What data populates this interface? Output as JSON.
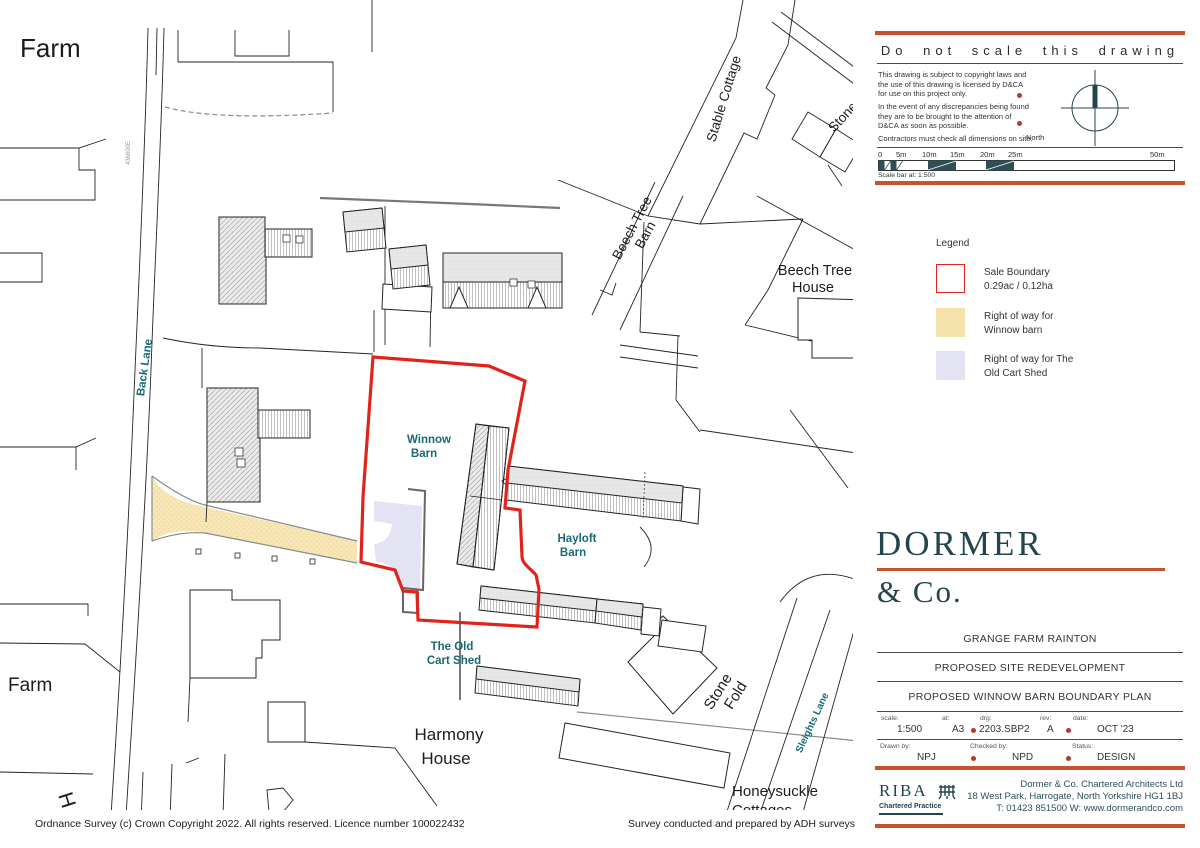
{
  "map": {
    "labels": {
      "farm_top": "Farm",
      "farm_bottom": "Farm",
      "h_partial": "H",
      "grid_ref": "436600E",
      "back_lane": "Back Lane",
      "stable_cottage": "Stable Cottage",
      "stone_top": "Stone",
      "beech_tree_barn_1": "Beech Tree",
      "beech_tree_barn_2": "Barn",
      "beech_tree_house_1": "Beech Tree",
      "beech_tree_house_2": "House",
      "winnow_1": "Winnow",
      "winnow_2": "Barn",
      "hayloft_1": "Hayloft",
      "hayloft_2": "Barn",
      "cart_shed_1": "The Old",
      "cart_shed_2": "Cart Shed",
      "harmony_1": "Harmony",
      "harmony_2": "House",
      "stone_fold_1": "Stone",
      "stone_fold_2": "Fold",
      "sleights_lane": "Sleights Lane",
      "honeysuckle_1": "Honeysuckle",
      "honeysuckle_2": "Cottages"
    },
    "colors": {
      "boundary_red": "#e0241b",
      "right_of_way_yellow": "#f7e7bb",
      "right_of_way_lavender": "#e4e3f4",
      "teal_label": "#186a74"
    }
  },
  "panel": {
    "notes": {
      "title": "Do not scale this drawing",
      "para1": "This drawing is subject to copyright laws and the use of this drawing is licensed by D&CA for use on this project only.",
      "para2": "In the event of any discrepancies being found they are to be brought to the attention of D&CA as soon as possible.",
      "para3": "Contractors must check all dimensions on site.",
      "north_label": "North"
    },
    "scalebar": {
      "labels": [
        "0",
        "5m",
        "10m",
        "15m",
        "20m",
        "25m",
        "50m"
      ],
      "caption": "Scale bar at: 1:500"
    },
    "legend": {
      "title": "Legend",
      "items": [
        {
          "line1": "Sale Boundary",
          "line2": "0.29ac / 0.12ha"
        },
        {
          "line1": "Right of way for",
          "line2": "Winnow barn"
        },
        {
          "line1": "Right of way for The",
          "line2": "Old Cart Shed"
        }
      ]
    },
    "logo": {
      "name": "DORMER",
      "sub": "& Co."
    },
    "titleblock": {
      "project": "GRANGE FARM RAINTON",
      "scheme": "PROPOSED SITE REDEVELOPMENT",
      "drawing": "PROPOSED WINNOW BARN BOUNDARY PLAN",
      "meta": {
        "scale_label": "scale:",
        "scale": "1:500",
        "at_label": "at:",
        "at": "A3",
        "drg_label": "drg:",
        "drg": "2203.SBP2",
        "rev_label": "rev:",
        "rev": "A",
        "date_label": "date:",
        "date": "OCT '23"
      },
      "people": {
        "drawn_label": "Drawn by:",
        "drawn": "NPJ",
        "checked_label": "Checked by:",
        "checked": "NPD",
        "status_label": "Status:",
        "status": "DESIGN"
      }
    },
    "firm": {
      "riba": "RIBA",
      "riba_sub": "Chartered Practice",
      "line1": "Dormer & Co. Chartered Architects Ltd",
      "line2": "18 West Park, Harrogate, North Yorkshire  HG1 1BJ",
      "line3": "T: 01423 851500   W: www.dormerandco.com"
    }
  },
  "footer": {
    "os_copyright": "Ordnance Survey (c) Crown Copyright 2022. All rights reserved. Licence number 100022432",
    "survey_credit": "Survey conducted and prepared by ADH surveys"
  }
}
